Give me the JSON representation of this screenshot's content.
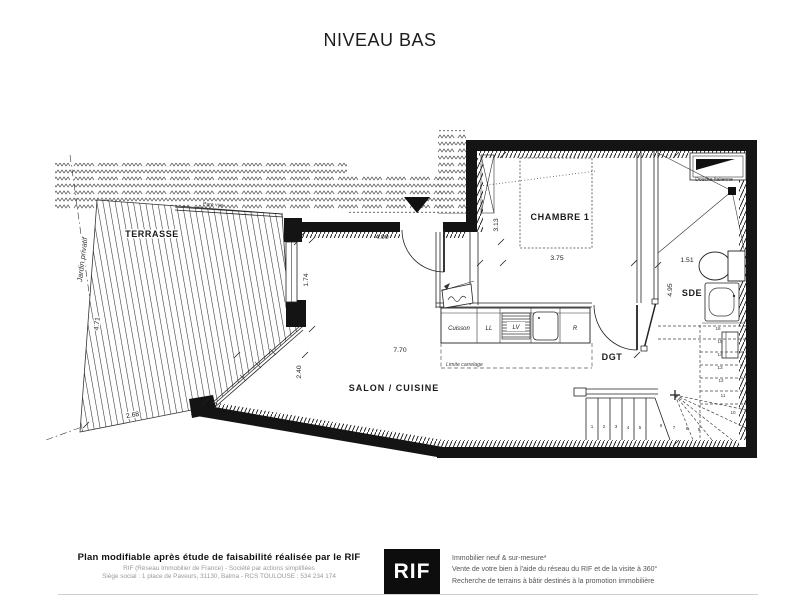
{
  "title": "NIVEAU BAS",
  "colors": {
    "line": "#141414",
    "logo_bg": "#0d0d0d"
  },
  "plan": {
    "rooms": {
      "terrasse": "TERRASSE",
      "chambre1": "CHAMBRE 1",
      "salon": "SALON / CUISINE",
      "sde": "SDE",
      "dgt": "DGT"
    },
    "labels": {
      "jardin": "Jardin privatif",
      "pare_vue": "Pare vue",
      "douche": "Douche Italienne",
      "limite_carrelage": "Limite carrelage"
    },
    "kitchen": {
      "cuisson": "Cuisson",
      "ll": "LL",
      "lv": "LV",
      "r": "R"
    },
    "dimensions": {
      "d400": "4.00",
      "d313": "3.13",
      "d375": "3.75",
      "d495": "4.95",
      "d151": "1.51",
      "d770": "7.70",
      "d240": "2.40",
      "d174": "1.74",
      "d471": "4.71",
      "d268": "2.68"
    },
    "stairs": {
      "numbers": [
        "1",
        "2",
        "3",
        "4",
        "5",
        "6",
        "7",
        "8",
        "9",
        "10",
        "11",
        "12",
        "13",
        "14",
        "15",
        "16"
      ]
    }
  },
  "footer": {
    "left": {
      "line1": "Plan modifiable après étude de faisabilité réalisée par le RIF",
      "line2": "RIF (Réseau Immobilier de France) - Société par actions simplifiées",
      "line3": "Siège social : 1 place de Paveurs, 31130, Balma - RCS TOULOUSE : 534 234 174"
    },
    "logo": "RIF",
    "right": {
      "line1": "Immobilier neuf & sur-mesure*",
      "line2": "Vente de votre bien à l'aide du réseau du RIF et de la visite à 360°",
      "line3": "Recherche de terrains à bâtir destinés à la promotion immobilière"
    }
  }
}
